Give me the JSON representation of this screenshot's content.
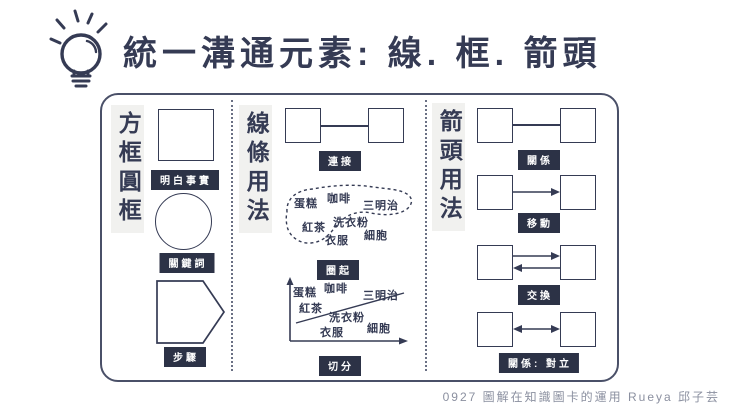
{
  "header": {
    "title": "統一溝通元素: 線. 框. 箭頭",
    "icon": "lightbulb"
  },
  "panel": {
    "boxes": {
      "header": "方框圓框",
      "items": [
        {
          "shape": "square",
          "label": "明白事實"
        },
        {
          "shape": "circle",
          "label": "關鍵詞"
        },
        {
          "shape": "pentagon",
          "label": "步驟"
        }
      ]
    },
    "lines": {
      "header": "線條用法",
      "examples": [
        {
          "type": "connect",
          "label": "連接"
        },
        {
          "type": "enclose",
          "label": "圈起"
        },
        {
          "type": "divide",
          "label": "切分"
        }
      ],
      "blob_words": [
        "蛋糕",
        "咖啡",
        "三明治",
        "紅茶",
        "洗衣粉",
        "衣服",
        "細胞"
      ],
      "divide_words": [
        "蛋糕",
        "咖啡",
        "三明治",
        "紅茶",
        "洗衣粉",
        "衣服",
        "細胞"
      ]
    },
    "arrows": {
      "header": "箭頭用法",
      "items": [
        {
          "connector": "line",
          "label": "關係"
        },
        {
          "connector": "arrow-right",
          "label": "移動"
        },
        {
          "connector": "arrows-both-ways",
          "label": "交換"
        },
        {
          "connector": "double-headed-arrow",
          "label": "關係: 對立"
        }
      ]
    }
  },
  "footer": {
    "credit": "0927 圖解在知識圖卡的運用 Rueya 邱子芸"
  },
  "colors": {
    "ink": "#353b54",
    "badge_bg": "#2c3246",
    "badge_text": "#ffffff",
    "header_bg": "#f1f1ef",
    "panel_border": "#4a5068",
    "divider": "#6a7084",
    "footer_text": "#8b90a0",
    "canvas_bg": "#ffffff"
  }
}
